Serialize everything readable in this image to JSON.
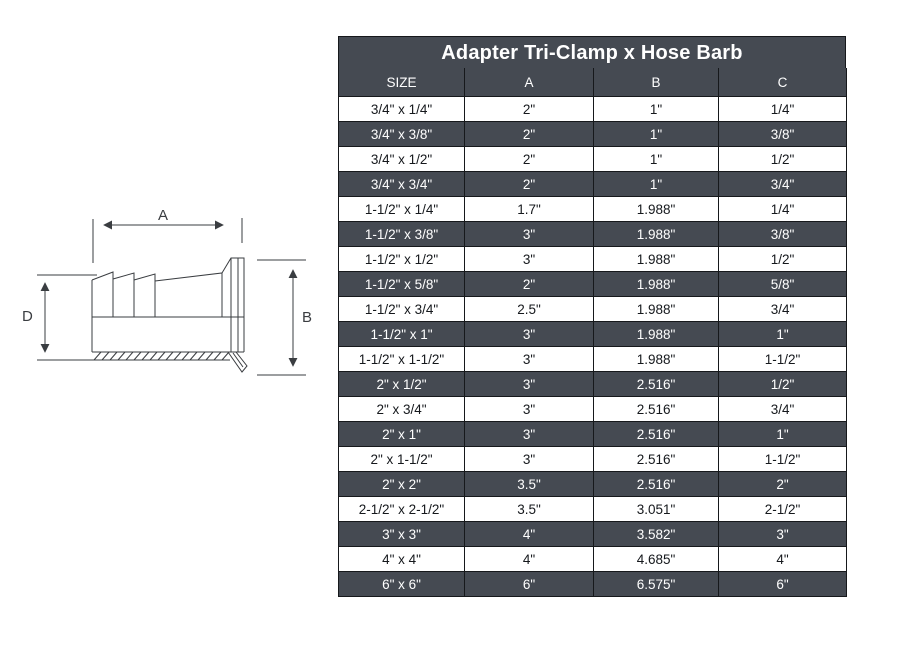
{
  "table": {
    "title": "Adapter Tri-Clamp x Hose Barb",
    "columns": [
      "SIZE",
      "A",
      "B",
      "C"
    ],
    "rows": [
      [
        "3/4\" x 1/4\"",
        "2\"",
        "1\"",
        "1/4\""
      ],
      [
        "3/4\" x 3/8\"",
        "2\"",
        "1\"",
        "3/8\""
      ],
      [
        "3/4\" x 1/2\"",
        "2\"",
        "1\"",
        "1/2\""
      ],
      [
        "3/4\" x 3/4\"",
        "2\"",
        "1\"",
        "3/4\""
      ],
      [
        "1-1/2\" x 1/4\"",
        "1.7\"",
        "1.988\"",
        "1/4\""
      ],
      [
        "1-1/2\" x 3/8\"",
        "3\"",
        "1.988\"",
        "3/8\""
      ],
      [
        "1-1/2\" x 1/2\"",
        "3\"",
        "1.988\"",
        "1/2\""
      ],
      [
        "1-1/2\" x 5/8\"",
        "2\"",
        "1.988\"",
        "5/8\""
      ],
      [
        "1-1/2\" x 3/4\"",
        "2.5\"",
        "1.988\"",
        "3/4\""
      ],
      [
        "1-1/2\" x 1\"",
        "3\"",
        "1.988\"",
        "1\""
      ],
      [
        "1-1/2\" x 1-1/2\"",
        "3\"",
        "1.988\"",
        "1-1/2\""
      ],
      [
        "2\" x 1/2\"",
        "3\"",
        "2.516\"",
        "1/2\""
      ],
      [
        "2\" x 3/4\"",
        "3\"",
        "2.516\"",
        "3/4\""
      ],
      [
        "2\" x 1\"",
        "3\"",
        "2.516\"",
        "1\""
      ],
      [
        "2\" x 1-1/2\"",
        "3\"",
        "2.516\"",
        "1-1/2\""
      ],
      [
        "2\" x 2\"",
        "3.5\"",
        "2.516\"",
        "2\""
      ],
      [
        "2-1/2\" x 2-1/2\"",
        "3.5\"",
        "3.051\"",
        "2-1/2\""
      ],
      [
        "3\" x 3\"",
        "4\"",
        "3.582\"",
        "3\""
      ],
      [
        "4\" x 4\"",
        "4\"",
        "4.685\"",
        "4\""
      ],
      [
        "6\" x 6\"",
        "6\"",
        "6.575\"",
        "6\""
      ]
    ]
  },
  "diagram": {
    "dim_a": "A",
    "dim_b": "B",
    "dim_d": "D"
  },
  "colors": {
    "row_dark": "#454a52",
    "row_light": "#ffffff",
    "grid_border": "#16181b",
    "line_art": "#3a3d41"
  }
}
